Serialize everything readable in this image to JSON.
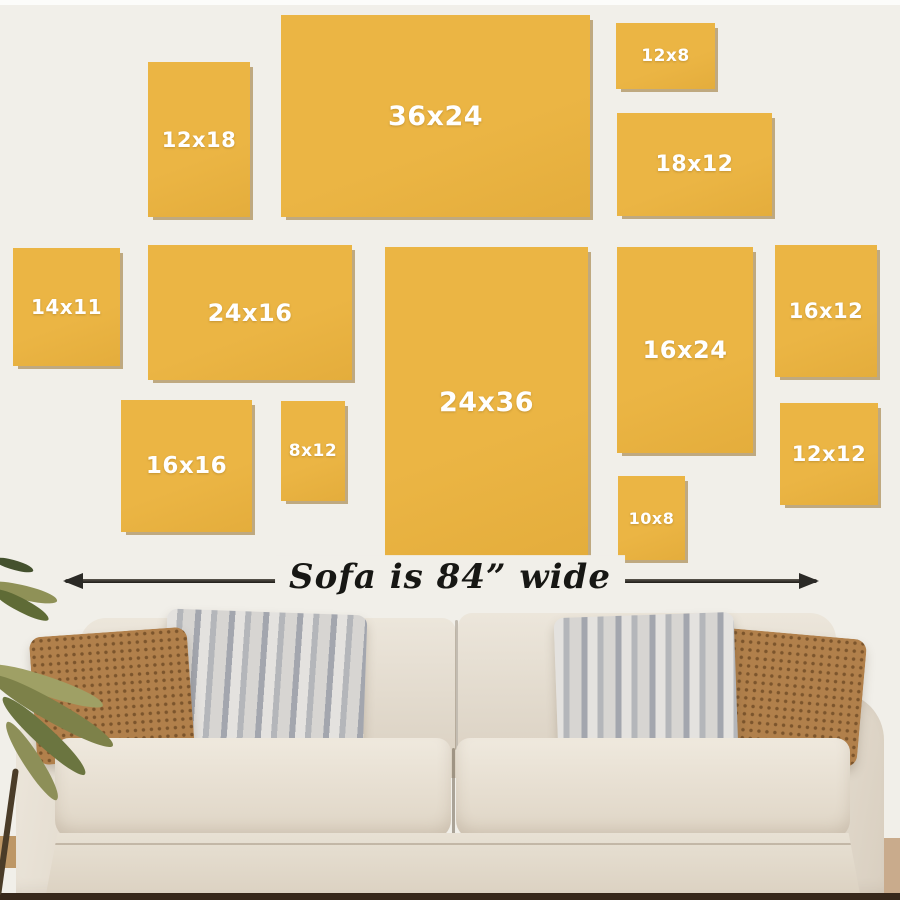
{
  "wall": {
    "background": "#f1efe9",
    "top_band": "#fcfcfa"
  },
  "frames": {
    "color": "#ebb544",
    "shadow_color": "#aa8136",
    "label_color": "#ffffff",
    "items": [
      {
        "label": "12x18",
        "x": 148,
        "y": 62,
        "w": 102,
        "h": 155,
        "fs": 21
      },
      {
        "label": "36x24",
        "x": 281,
        "y": 15,
        "w": 309,
        "h": 202,
        "fs": 27
      },
      {
        "label": "12x8",
        "x": 616,
        "y": 23,
        "w": 99,
        "h": 66,
        "fs": 17
      },
      {
        "label": "18x12",
        "x": 617,
        "y": 113,
        "w": 155,
        "h": 103,
        "fs": 22
      },
      {
        "label": "14x11",
        "x": 13,
        "y": 248,
        "w": 107,
        "h": 118,
        "fs": 20
      },
      {
        "label": "24x16",
        "x": 148,
        "y": 245,
        "w": 204,
        "h": 135,
        "fs": 24
      },
      {
        "label": "16x16",
        "x": 121,
        "y": 400,
        "w": 131,
        "h": 132,
        "fs": 23
      },
      {
        "label": "8x12",
        "x": 281,
        "y": 401,
        "w": 64,
        "h": 100,
        "fs": 17
      },
      {
        "label": "24x36",
        "x": 385,
        "y": 247,
        "w": 203,
        "h": 310,
        "fs": 27
      },
      {
        "label": "16x24",
        "x": 617,
        "y": 247,
        "w": 136,
        "h": 206,
        "fs": 24
      },
      {
        "label": "16x12",
        "x": 775,
        "y": 245,
        "w": 102,
        "h": 132,
        "fs": 21
      },
      {
        "label": "12x12",
        "x": 780,
        "y": 403,
        "w": 98,
        "h": 102,
        "fs": 21
      },
      {
        "label": "10x8",
        "x": 618,
        "y": 476,
        "w": 67,
        "h": 84,
        "fs": 16
      }
    ]
  },
  "dimension_arrow": {
    "label": "Sofa is 84” wide",
    "color": "#2b2a26"
  },
  "sofa": {
    "fabric_color": "#e7dfd2",
    "pillow_brown": "#b1804b",
    "pillow_gray": "#c6c6c8"
  },
  "floor_color": "#37281b"
}
